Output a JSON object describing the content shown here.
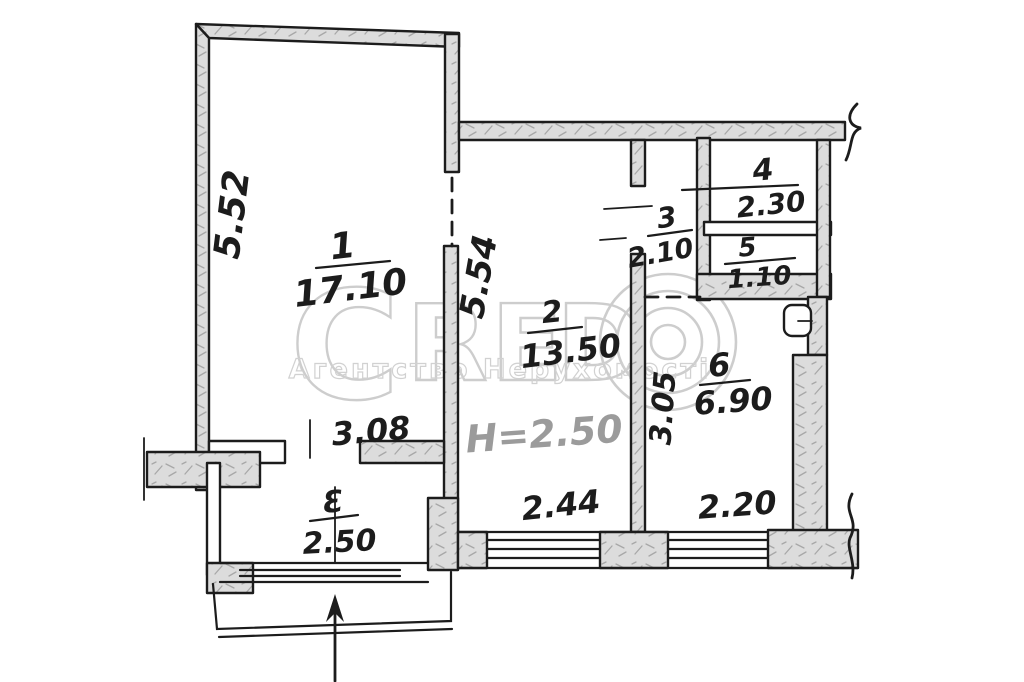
{
  "plan": {
    "rooms": [
      {
        "number": "1",
        "area": "17.10"
      },
      {
        "number": "2",
        "area": "13.50"
      },
      {
        "number": "3",
        "area": "2.10"
      },
      {
        "number": "4",
        "area": "2.30"
      },
      {
        "number": "5",
        "area": "1.10"
      },
      {
        "number": "6",
        "area": "6.90"
      },
      {
        "number": "Ɛ",
        "area": "2.50"
      }
    ],
    "dimensions": {
      "room1_height": "5.52",
      "room2_height": "5.54",
      "room1_bottom_width": "3.08",
      "room2_bottom_width": "2.44",
      "room6_bottom_width": "2.20",
      "room6_height": "3.05",
      "ceiling_height": "H=2.50"
    }
  },
  "watermark": {
    "letter_c": "С",
    "letter_r": "R",
    "letter_e": "Е",
    "letter_d": "D",
    "subtitle": "Агентство Нерухомості"
  },
  "colors": {
    "ink": "#1c1c1c",
    "wall_fill": "#dcdcdc",
    "wall_speckle": "#a8a8a8",
    "watermark": "#c5c5c5",
    "ceiling_text": "#9b9b9b",
    "paper": "#ffffff"
  }
}
